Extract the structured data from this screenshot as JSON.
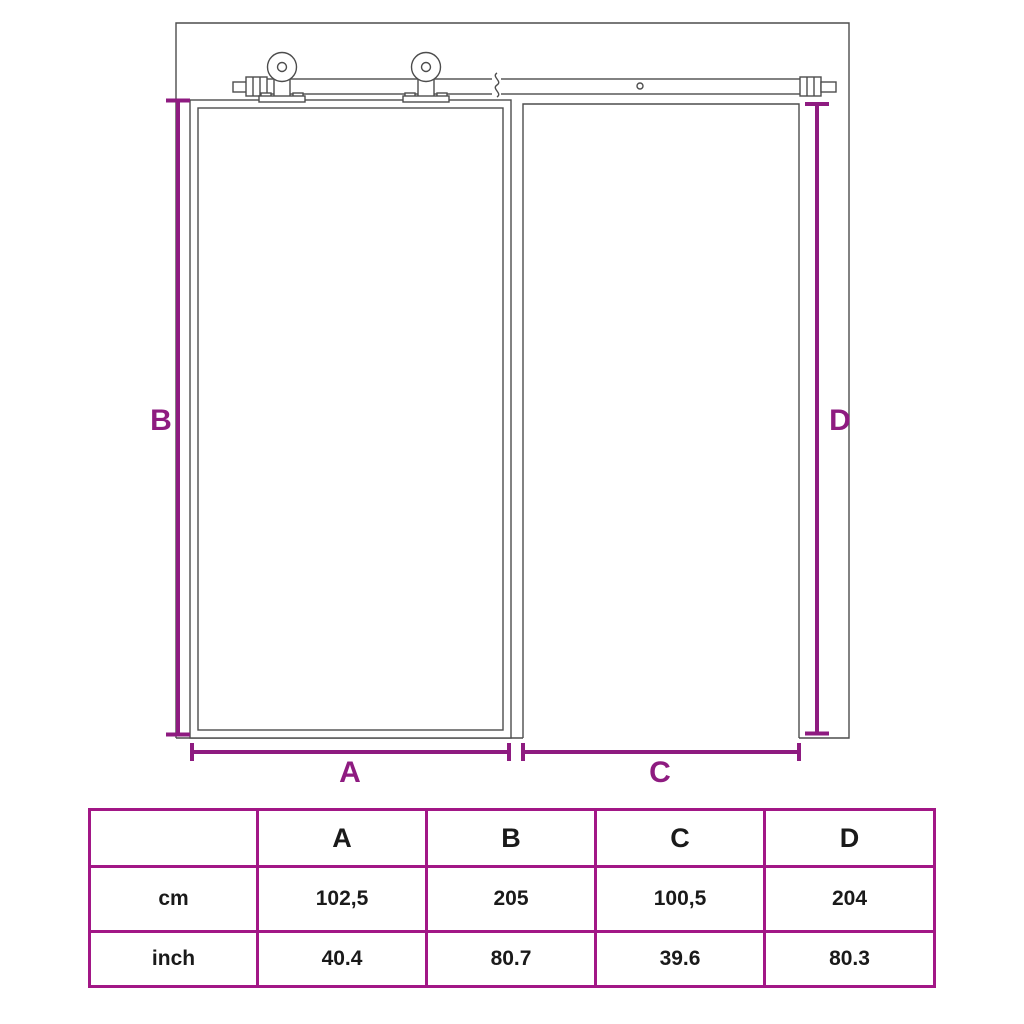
{
  "diagram": {
    "labels": {
      "a": "A",
      "b": "B",
      "c": "C",
      "d": "D"
    }
  },
  "table": {
    "header": [
      "",
      "A",
      "B",
      "C",
      "D"
    ],
    "rows": [
      {
        "unit": "cm",
        "values": [
          "102,5",
          "205",
          "100,5",
          "204"
        ]
      },
      {
        "unit": "inch",
        "values": [
          "40.4",
          "80.7",
          "39.6",
          "80.3"
        ]
      }
    ]
  },
  "colors": {
    "dimension_purple": "#8e1b80",
    "table_border_purple": "#a21786",
    "drawing_gray": "#4d4d4d",
    "text_black": "#1a1a1a",
    "background": "#ffffff"
  }
}
